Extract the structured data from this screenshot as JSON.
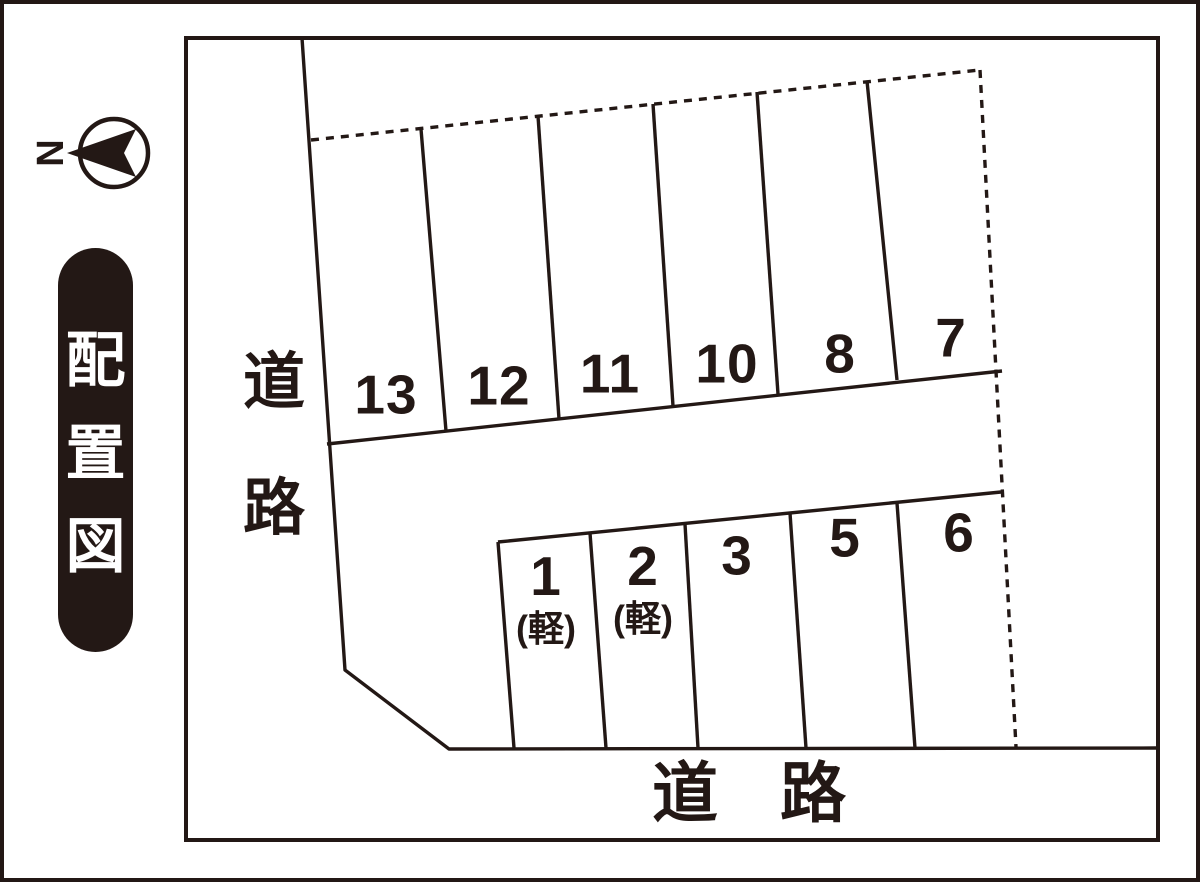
{
  "title": {
    "chars": [
      "配",
      "置",
      "図"
    ]
  },
  "compass": {
    "letter": "N"
  },
  "roads": {
    "left": {
      "chars": [
        "道",
        "路"
      ]
    },
    "bottom": {
      "chars": [
        "道",
        "路"
      ]
    }
  },
  "parking": {
    "top_row": [
      {
        "number": "13"
      },
      {
        "number": "12"
      },
      {
        "number": "11"
      },
      {
        "number": "10"
      },
      {
        "number": "8"
      },
      {
        "number": "7"
      }
    ],
    "bottom_row": [
      {
        "number": "1",
        "size_note": "(軽)"
      },
      {
        "number": "2",
        "size_note": "(軽)"
      },
      {
        "number": "3"
      },
      {
        "number": "5"
      },
      {
        "number": "6"
      }
    ]
  },
  "colors": {
    "ink": "#231815",
    "paper": "#ffffff",
    "title_bg": "#231815",
    "title_fg": "#ffffff"
  }
}
